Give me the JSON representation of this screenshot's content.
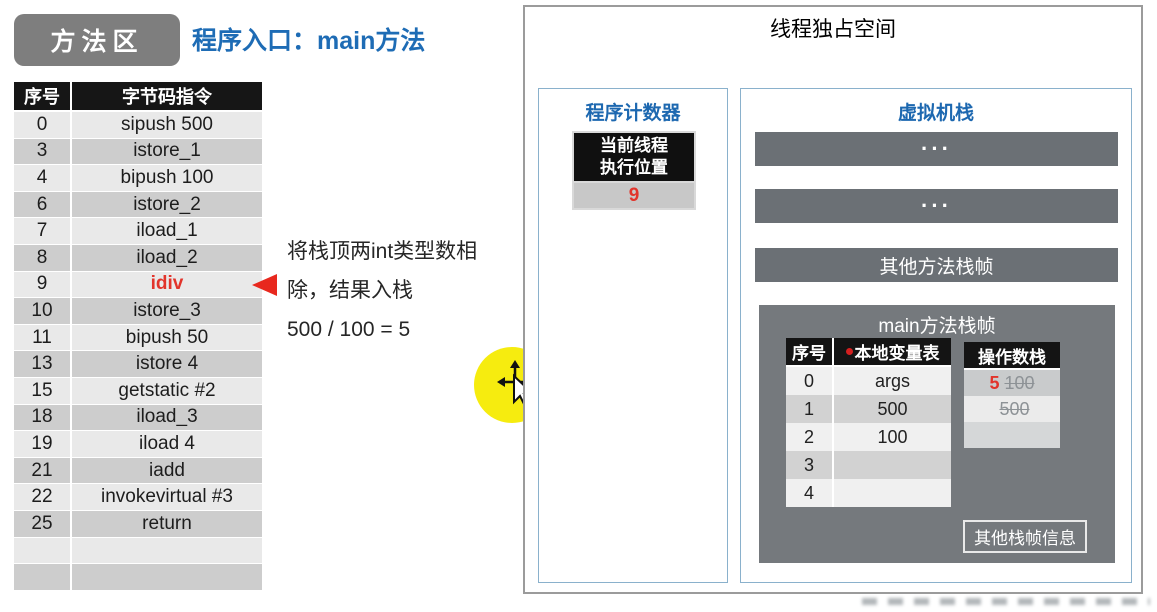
{
  "colors": {
    "accent_blue": "#1e6cb5",
    "highlight_red": "#e2342b",
    "cursor_yellow": "#f6ec0f",
    "bar_gray": "#6b7075",
    "frame_gray": "#75797d"
  },
  "method_area": {
    "badge": "方法区",
    "entry_title": "程序入口：main方法",
    "table": {
      "headers": [
        "序号",
        "字节码指令"
      ],
      "rows": [
        {
          "index": "0",
          "instruction": "sipush 500"
        },
        {
          "index": "3",
          "instruction": "istore_1"
        },
        {
          "index": "4",
          "instruction": "bipush 100"
        },
        {
          "index": "6",
          "instruction": "istore_2"
        },
        {
          "index": "7",
          "instruction": "iload_1"
        },
        {
          "index": "8",
          "instruction": "iload_2"
        },
        {
          "index": "9",
          "instruction": "idiv"
        },
        {
          "index": "10",
          "instruction": "istore_3"
        },
        {
          "index": "11",
          "instruction": "bipush 50"
        },
        {
          "index": "13",
          "instruction": "istore 4"
        },
        {
          "index": "15",
          "instruction": "getstatic #2"
        },
        {
          "index": "18",
          "instruction": "iload_3"
        },
        {
          "index": "19",
          "instruction": "iload 4"
        },
        {
          "index": "21",
          "instruction": "iadd"
        },
        {
          "index": "22",
          "instruction": "invokevirtual #3"
        },
        {
          "index": "25",
          "instruction": "return"
        },
        {
          "index": "",
          "instruction": ""
        },
        {
          "index": "",
          "instruction": ""
        }
      ]
    }
  },
  "annotation": {
    "line1": "将栈顶两int类型数相",
    "line2": "除，结果入栈",
    "line3": "500 / 100 = 5"
  },
  "thread_space": {
    "title": "线程独占空间",
    "program_counter": {
      "title": "程序计数器",
      "label_line1": "当前线程",
      "label_line2": "执行位置",
      "value": "9"
    },
    "vm_stack": {
      "title": "虚拟机栈",
      "bar1": "···",
      "bar2": "···",
      "bar3": "其他方法栈帧",
      "main_frame": {
        "title": "main方法栈帧",
        "local_vars": {
          "headers": [
            "序号",
            "本地变量表"
          ],
          "rows": [
            {
              "index": "0",
              "value": "args"
            },
            {
              "index": "1",
              "value": "500"
            },
            {
              "index": "2",
              "value": "100"
            },
            {
              "index": "3",
              "value": ""
            },
            {
              "index": "4",
              "value": ""
            }
          ]
        },
        "operand_stack": {
          "header": "操作数栈",
          "rows": [
            {
              "new_value": "5",
              "old_value": "100"
            },
            {
              "new_value": "",
              "old_value": "500"
            },
            {
              "new_value": "",
              "old_value": ""
            }
          ]
        },
        "other_info": "其他栈帧信息"
      }
    }
  }
}
